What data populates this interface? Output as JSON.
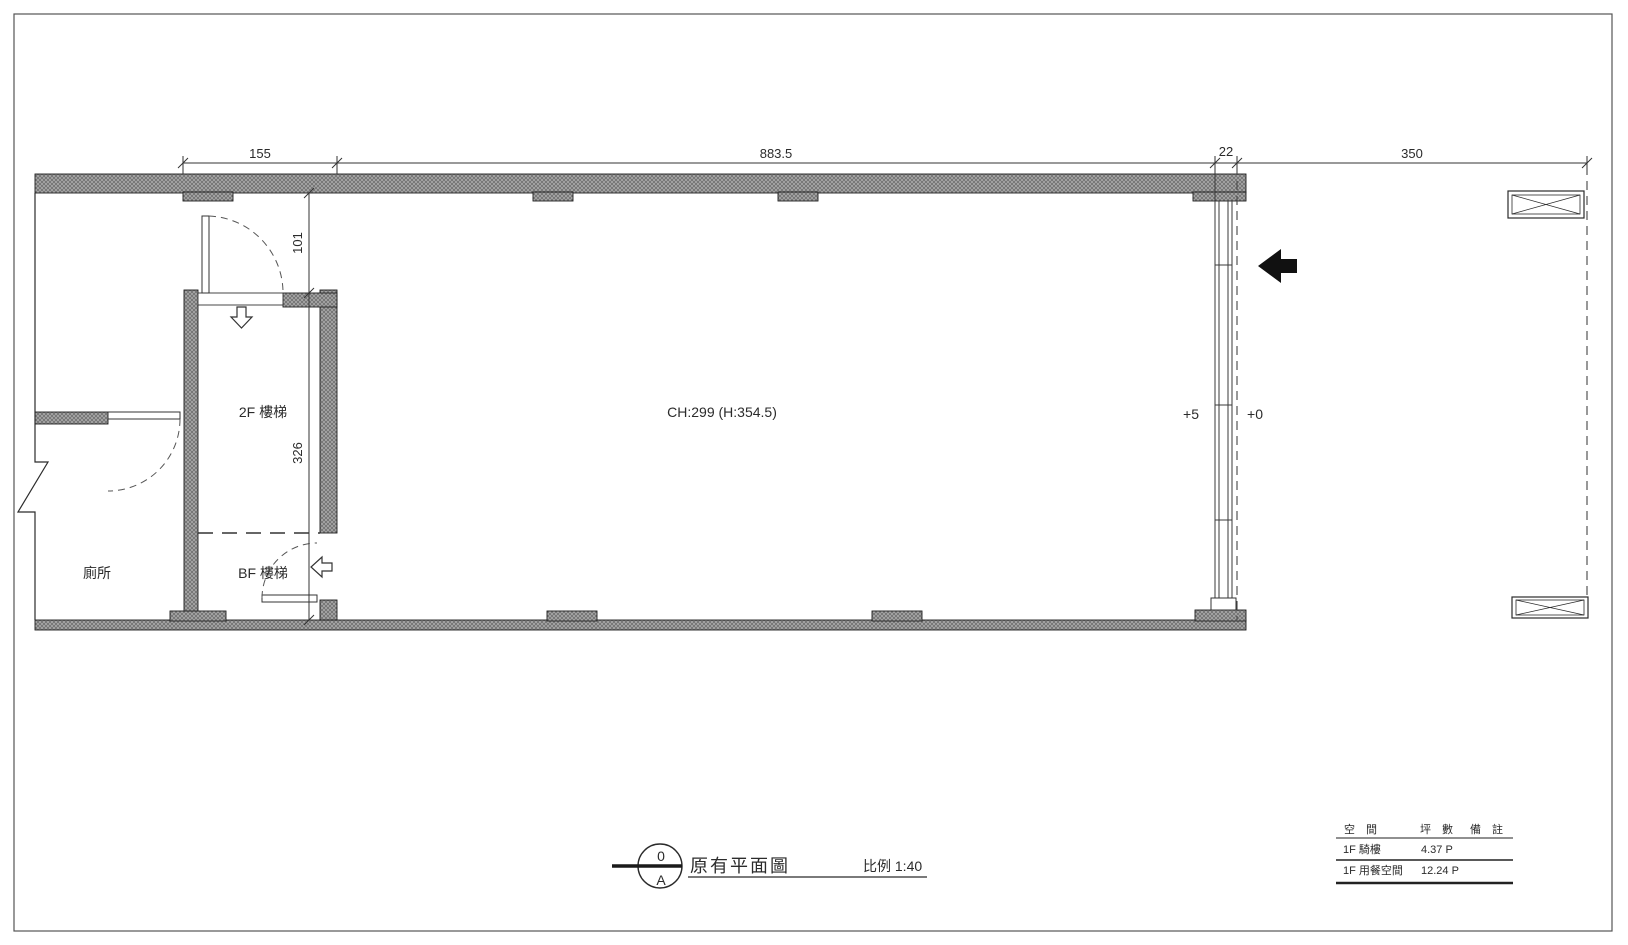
{
  "sheet": {
    "dims_top": {
      "d155": "155",
      "d883": "883.5",
      "d22": "22",
      "d350": "350"
    },
    "dims_side": {
      "d101": "101",
      "d326": "326"
    },
    "rooms": {
      "stair2f": "2F 樓梯",
      "stairbf": "BF 樓梯",
      "toilet": "廁所"
    },
    "notes": {
      "ceiling": "CH:299 (H:354.5)",
      "level_in": "+5",
      "level_out": "+0"
    },
    "titleblock": {
      "num": "0",
      "letter": "A",
      "title": "原有平面圖",
      "scale": "比例 1:40"
    },
    "table": {
      "headers": [
        "空 間",
        "坪 數",
        "備 註"
      ],
      "rows": [
        {
          "space": "1F 騎樓",
          "area": "4.37 P",
          "note": ""
        },
        {
          "space": "1F 用餐空間",
          "area": "12.24 P",
          "note": ""
        }
      ]
    },
    "colors": {
      "line": "#2b2b2b",
      "wall_fill": "#ababab",
      "wall_hatch": "#6e6e6e",
      "arrow_fill": "#111111"
    }
  }
}
